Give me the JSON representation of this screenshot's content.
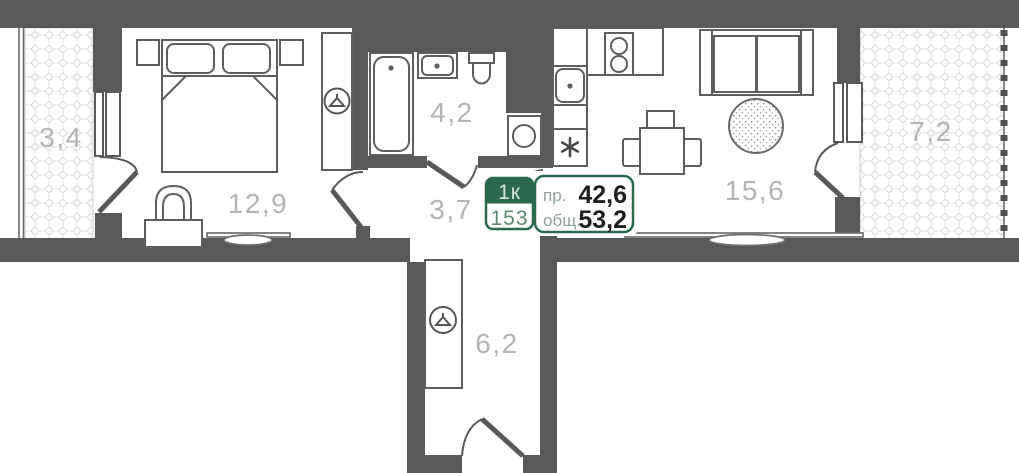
{
  "floor_plan": {
    "badge": {
      "unit_type": "1к",
      "unit_number": "153",
      "living_label": "пр.",
      "living_area": "42,6",
      "total_label": "общ.",
      "total_area": "53,2"
    },
    "rooms": [
      {
        "id": "balcony-left",
        "area": "3,4"
      },
      {
        "id": "bedroom",
        "area": "12,9"
      },
      {
        "id": "bathroom",
        "area": "4,2"
      },
      {
        "id": "hallway",
        "area": "3,7"
      },
      {
        "id": "kitchen-living",
        "area": "15,6"
      },
      {
        "id": "balcony-right",
        "area": "7,2"
      },
      {
        "id": "corridor",
        "area": "6,2"
      }
    ],
    "icons": {
      "wardrobe_bedroom": "hanger-icon",
      "wardrobe_corridor": "hanger-icon",
      "fridge": "snowflake-icon",
      "stove": "two-burner-icon",
      "sinks": "drain-dot-icon"
    },
    "colors": {
      "wall": "#58595b",
      "accent_green": "#2b6a4c",
      "accent_green_light": "#d7e4dc",
      "accent_green_mid": "#5d8b72",
      "label_gray": "#b4b4b4",
      "number_dark": "#1e1e1e"
    }
  }
}
